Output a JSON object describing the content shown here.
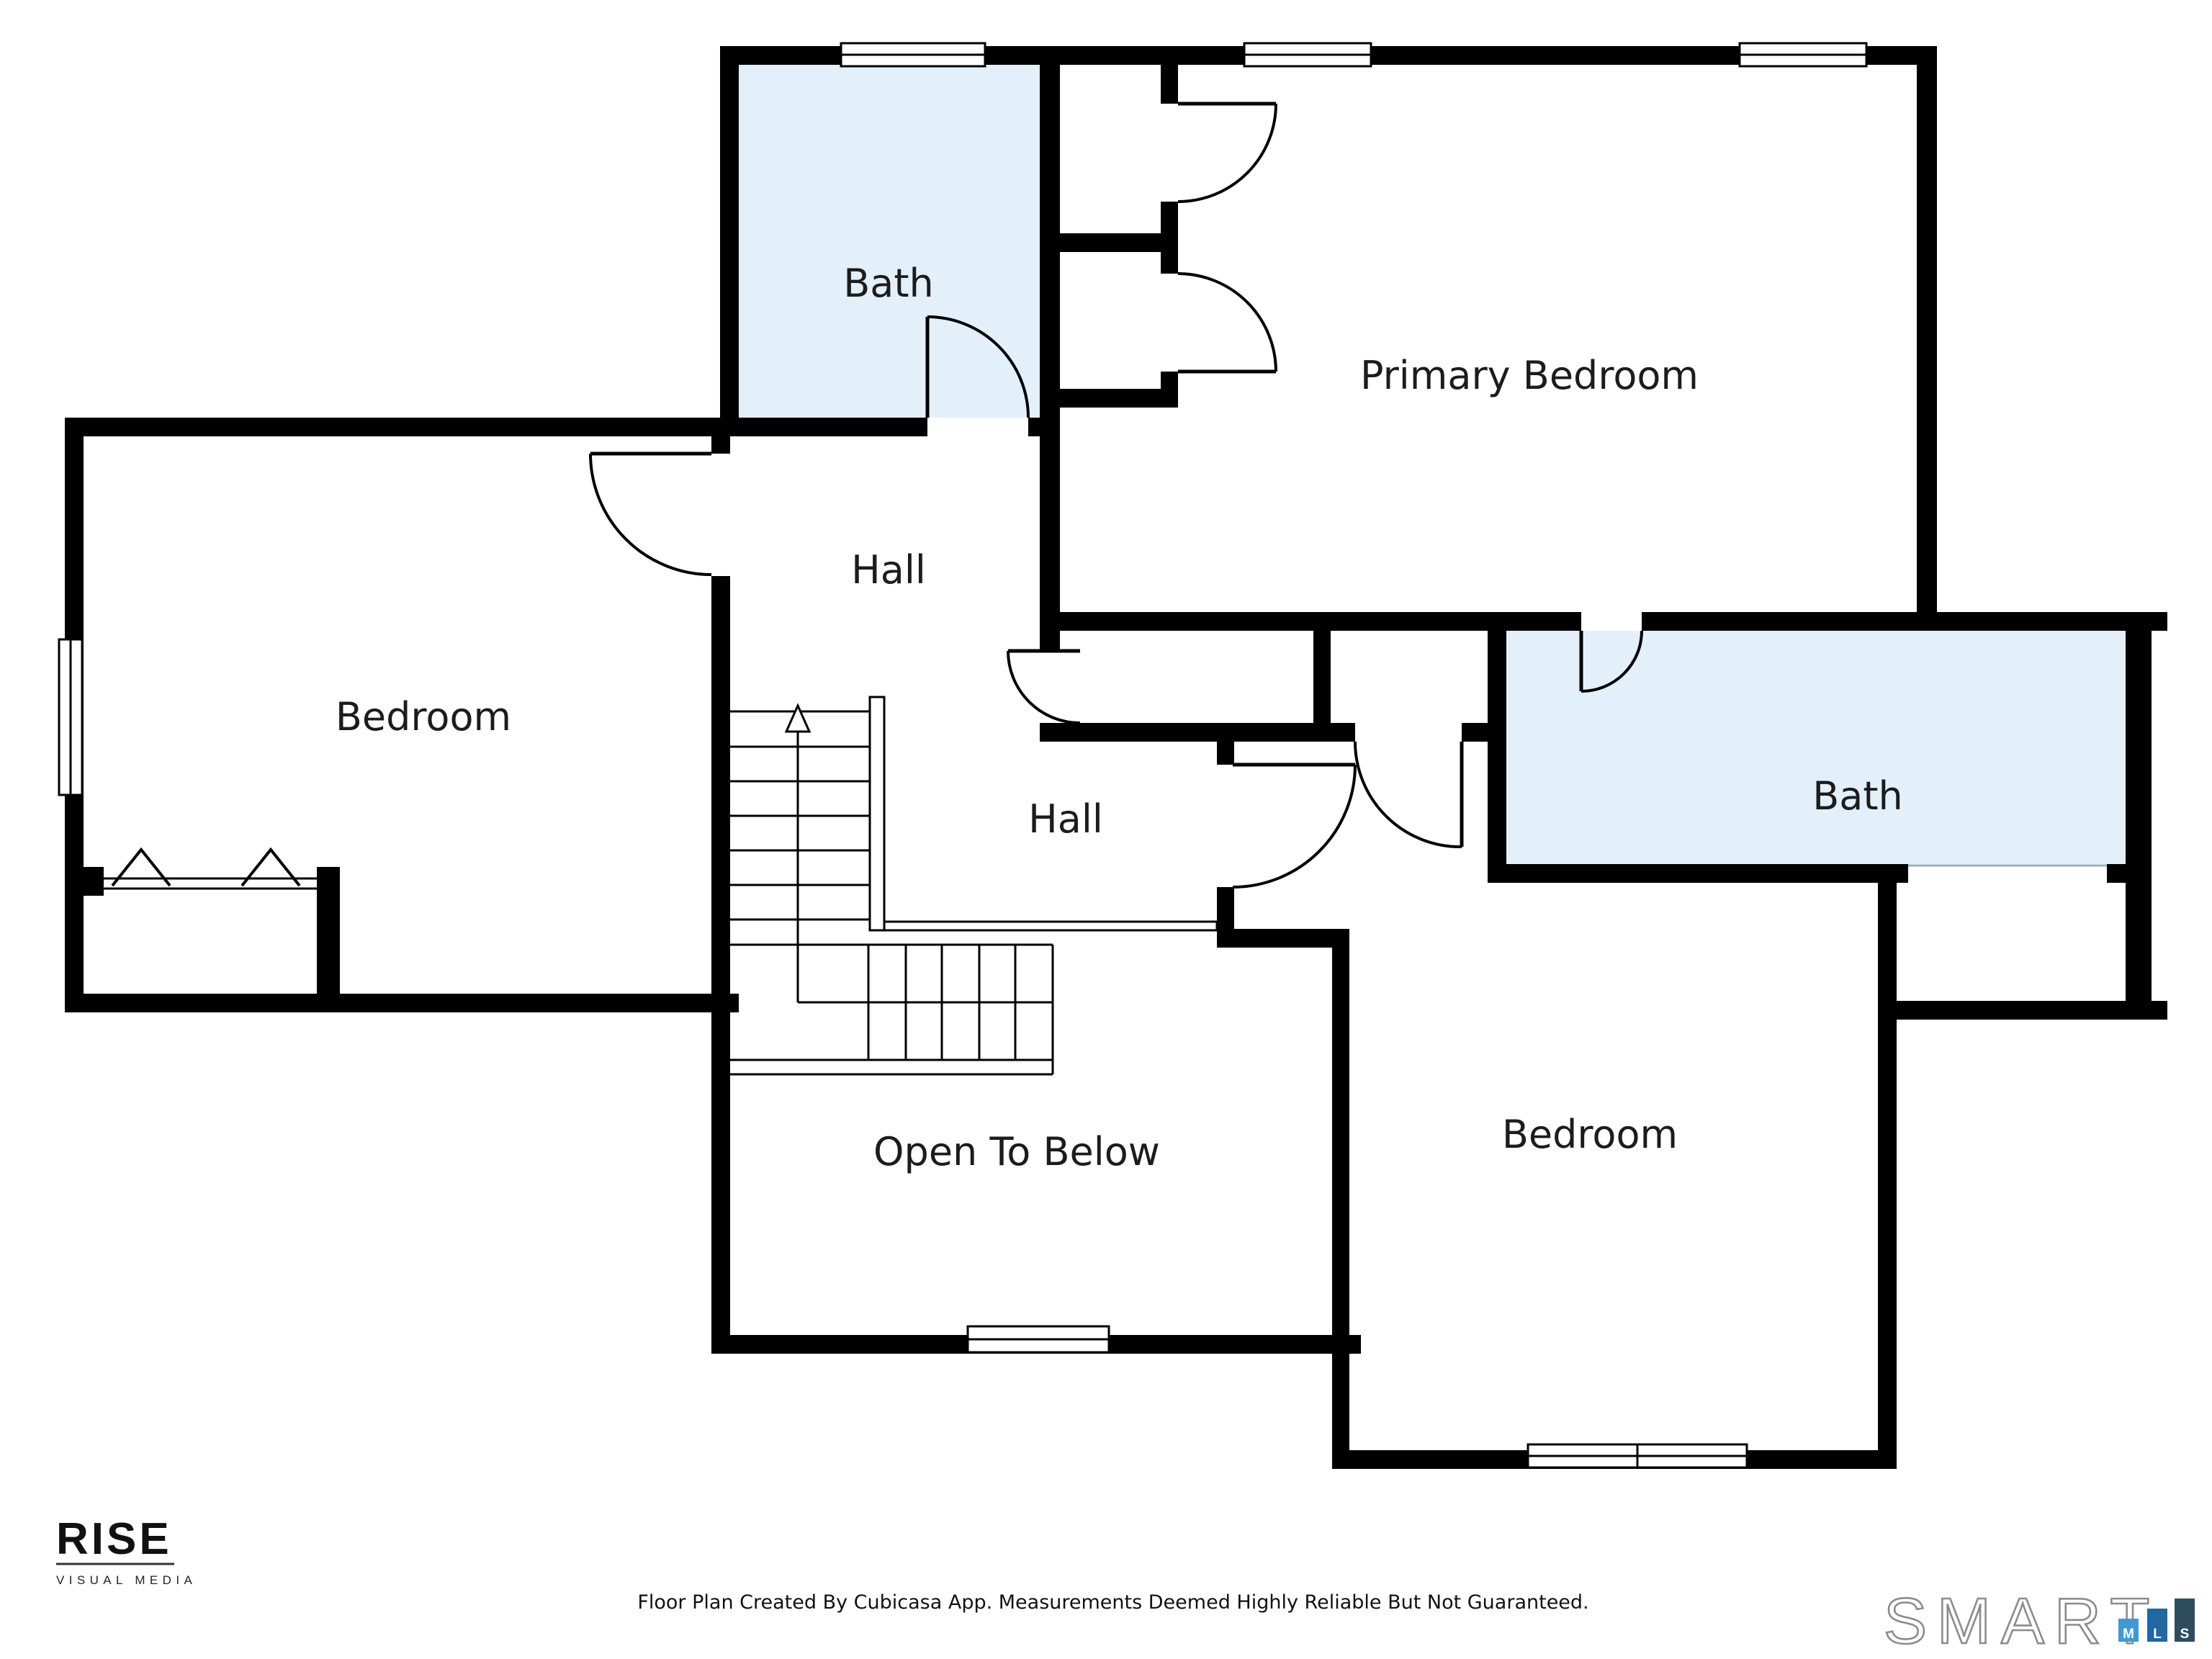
{
  "rooms": [
    {
      "id": "bath-1",
      "label": "Bath"
    },
    {
      "id": "primary-bedroom",
      "label": "Primary Bedroom"
    },
    {
      "id": "bedroom-left",
      "label": "Bedroom"
    },
    {
      "id": "hall-upper",
      "label": "Hall"
    },
    {
      "id": "hall-lower",
      "label": "Hall"
    },
    {
      "id": "bath-2",
      "label": "Bath"
    },
    {
      "id": "bedroom-right",
      "label": "Bedroom"
    },
    {
      "id": "open-to-below",
      "label": "Open To Below"
    }
  ],
  "colors": {
    "wall": "#000000",
    "bath_fill": "#e3f0fa",
    "text": "#1c1c1c"
  },
  "footer": {
    "disclaimer": "Floor Plan Created By Cubicasa App. Measurements Deemed Highly Reliable But Not Guaranteed.",
    "rise_logo": {
      "name": "RISE",
      "tagline": "VISUAL MEDIA"
    },
    "smartmls_logo": {
      "name": "SMART",
      "bars": [
        {
          "letter": "M",
          "color": "#3f9ad2"
        },
        {
          "letter": "L",
          "color": "#2268a2"
        },
        {
          "letter": "S",
          "color": "#2d4d5e"
        }
      ]
    }
  }
}
